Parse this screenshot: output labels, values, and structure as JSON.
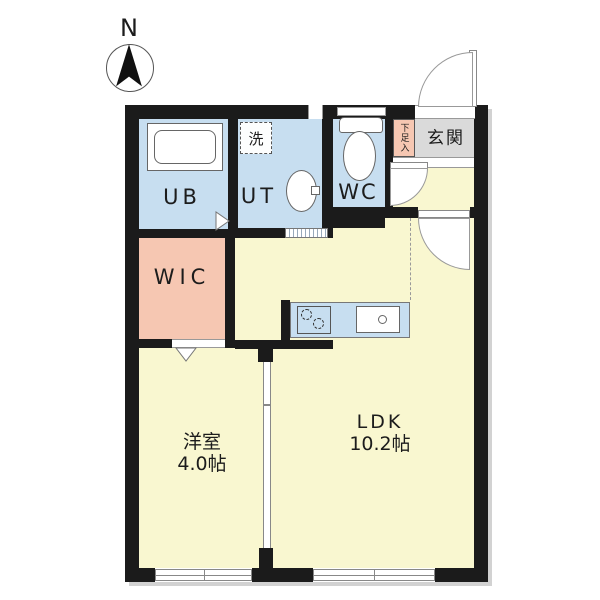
{
  "type": "floor-plan",
  "compass": {
    "label": "N"
  },
  "rooms": {
    "ub": {
      "label": "UB"
    },
    "ut": {
      "label": "UT"
    },
    "washer": {
      "label": "洗"
    },
    "wc": {
      "label": "WC"
    },
    "genkan": {
      "label": "玄関"
    },
    "shoe_storage": {
      "label": "下足入"
    },
    "wic": {
      "label": "WIC"
    },
    "bedroom": {
      "label": "洋室",
      "size": "4.0帖"
    },
    "ldk": {
      "label": "LDK",
      "size": "10.2帖"
    }
  },
  "colors": {
    "wall": "#1b1b1b",
    "wet-room": "#c7def0",
    "living": "#f9f7d0",
    "closet": "#f6c7b2",
    "entry": "#dadada",
    "line": "#888888"
  }
}
